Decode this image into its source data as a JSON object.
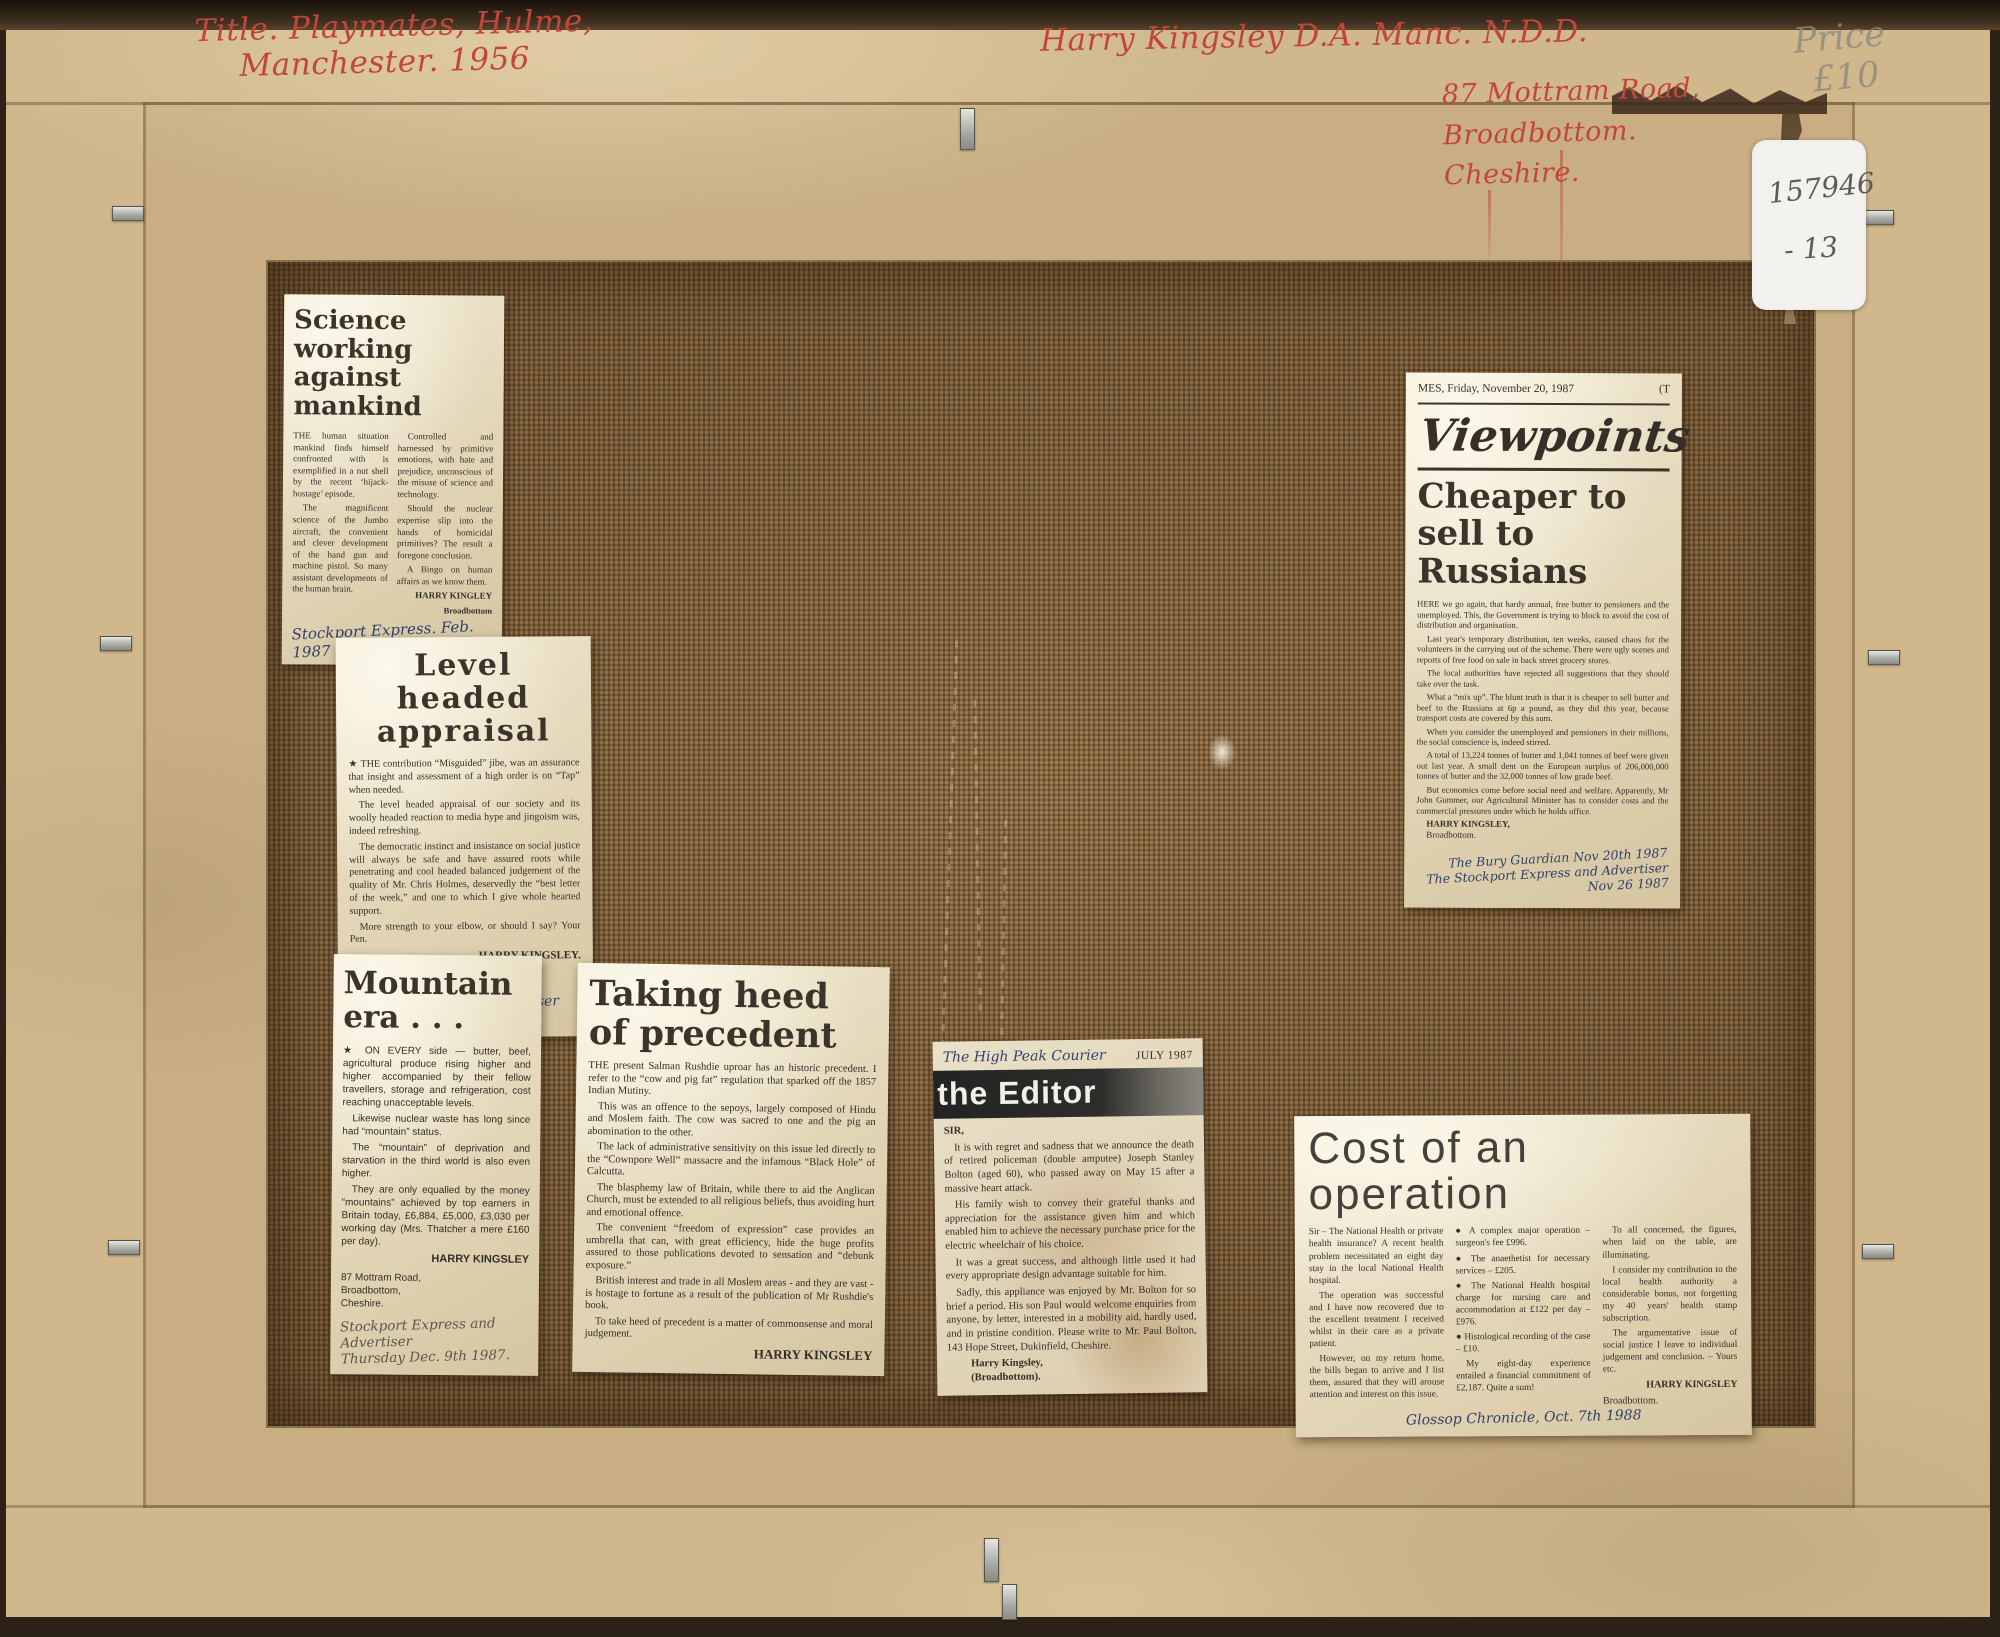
{
  "annotations": {
    "title": {
      "line1": "Title. Playmates, Hulme,",
      "line2": "Manchester. 1956"
    },
    "artist": {
      "name": "Harry Kingsley D.A. Manc. N.D.D.",
      "address_line1": "87 Mottram Road,",
      "address_line2": "Broadbottom.",
      "address_line3": "Cheshire."
    },
    "price": {
      "line1": "Price",
      "line2": "£10"
    },
    "sticker": {
      "line1": "157946",
      "line2": "- 13"
    },
    "ink_color": "#c2473a",
    "pencil_color": "#8d887e"
  },
  "clippings": {
    "science": {
      "headline": [
        "Science working",
        "against mankind"
      ],
      "paragraphs": [
        "THE human situation mankind finds himself confronted with is exemplified in a nut shell by the recent ‘hijack-hostage’ episode.",
        "The magnificent science of the Jumbo aircraft, the convenient and clever development of the hand gun and machine pistol. So many assistant developments of the human brain.",
        "Controlled and harnessed by primitive emotions, with hate and prejudice, unconscious of the misuse of science and technology.",
        "Should the nuclear expertise slip into the hands of homicidal primitives? The result a foregone conclusion.",
        "A Bingo on human affairs as we know them."
      ],
      "byline": "HARRY KINGLEY",
      "byline_place": "Broadbottom",
      "source": "Stockport Express. Feb. 1987"
    },
    "level": {
      "headline": [
        "Level headed",
        "appraisal"
      ],
      "paragraphs": [
        "★ THE contribution “Misguided” jibe, was an assurance that insight and assessment of a high order is on “Tap” when needed.",
        "The level headed appraisal of our society and its woolly headed reaction to media hype and jingoism was, indeed refreshing.",
        "The democratic instinct and insistance on social justice will always be safe and have assured roots while penetrating and cool headed balanced judgement of the quality of Mr. Chris Holmes, deservedly the “best letter of the week,” and one to which I give whole hearted support.",
        "More strength to your elbow, or should I say? Your Pen."
      ],
      "byline": "HARRY KINGSLEY.",
      "address": [
        "Mottram Road,",
        "Broadbottom"
      ],
      "source": "Stockport Express Advertiser Dec 31st 1987"
    },
    "mountain": {
      "headline": [
        "Mountain",
        "era . . ."
      ],
      "paragraphs": [
        "★ ON EVERY side — butter, beef, agricultural produce rising higher and higher accompanied by their fellow travellers, storage and refrigeration, cost reaching unacceptable levels.",
        "Likewise nuclear waste has long since had “mountain” status.",
        "The “mountain” of deprivation and starvation in the third world is also even higher.",
        "They are only equalled by the money “mountains” achieved by top earners in Britain today, £6,884, £5,000, £3,030 per working day (Mrs. Thatcher a mere £160 per day)."
      ],
      "byline": "HARRY KINGSLEY",
      "address": [
        "87 Mottram Road,",
        "Broadbottom,",
        "Cheshire."
      ],
      "source": [
        "Stockport Express and Advertiser",
        "Thursday Dec. 9th 1987."
      ]
    },
    "precedent": {
      "headline": [
        "Taking heed",
        "of precedent"
      ],
      "paragraphs": [
        "THE present Salman Rushdie uproar has an historic precedent. I refer to the “cow and pig fat” regulation that sparked off the 1857 Indian Mutiny.",
        "This was an offence to the sepoys, largely composed of Hindu and Moslem faith. The cow was sacred to one and the pig an abomination to the other.",
        "The lack of administrative sensitivity on this issue led directly to the “Cownpore Well” massacre and the infamous “Black Hole” of Calcutta.",
        "The blasphemy law of Britain, while there to aid the Anglican Church, must be extended to all religious beliefs, thus avoiding hurt and emotional offence.",
        "The convenient “freedom of expression” case provides an umbrella that can, with great efficiency, hide the huge profits assured to those publications devoted to sensation and “debunk exposure.”",
        "British interest and trade in all Moslem areas - and they are vast - is hostage to fortune as a result of the publication of Mr Rushdie's book.",
        "To take heed of precedent is a matter of commonsense and moral judgement."
      ],
      "byline": "HARRY KINGSLEY"
    },
    "editor": {
      "source_hand": "The High Peak Courier",
      "date_printed": "JULY 1987",
      "banner": "the Editor",
      "salutation": "SIR,",
      "paragraphs": [
        "It is with regret and sadness that we announce the death of retired policeman (double amputee) Joseph Stanley Bolton (aged 60), who passed away on May 15 after a massive heart attack.",
        "His family wish to convey their grateful thanks and appreciation for the assistance given him and which enabled him to achieve the necessary purchase price for the electric wheelchair of his choice.",
        "It was a great success, and although little used it had every appropriate design advantage suitable for him.",
        "Sadly, this appliance was enjoyed by Mr. Bolton for so brief a period. His son Paul would welcome enquiries from anyone, by letter, interested in a mobility aid, hardly used, and in pristine condition. Please write to Mr. Paul Bolton, 143 Hope Street, Dukinfield, Cheshire."
      ],
      "byline": "Harry Kingsley,",
      "byline_place": "(Broadbottom)."
    },
    "viewpoints": {
      "dateline": "MES, Friday, November 20, 1987",
      "dateline_right": "(T",
      "masthead": "Viewpoints",
      "headline": [
        "Cheaper to",
        "sell to",
        "Russians"
      ],
      "paragraphs": [
        "HERE we go again, that hardy annual, free butter to pensioners and the unemployed. This, the Government is trying to block to avoid the cost of distribution and organisation.",
        "Last year's temporary distribution, ten weeks, caused chaos for the volunteers in the carrying out of the scheme. There were ugly scenes and reports of free food on sale in back street grocery stores.",
        "The local authorities have rejected all suggestions that they should take over the task.",
        "What a “mix up”. The blunt truth is that it is cheaper to sell butter and beef to the Russians at 6p a pound, as they did this year, because transport costs are covered by this sum.",
        "When you consider the unemployed and pensioners in their millions, the social conscience is, indeed stirred.",
        "A total of 13,224 tonnes of butter and 1,041 tonnes of beef were given out last year. A small dent on the European surplus of 206,000,000 tonnes of butter and the 32,000 tonnes of low grade beef.",
        "But economics come before social need and welfare. Apparently, Mr John Gummer, our Agricultural Minister has to consider costs and the commercial pressures under which he holds office."
      ],
      "byline": "HARRY KINGSLEY,",
      "byline_place": "Broadbottom.",
      "source": [
        "The Bury Guardian Nov 20th 1987",
        "The Stockport Express and Advertiser Nov 26 1987"
      ]
    },
    "cost": {
      "headline": "Cost of an operation",
      "paragraphs": [
        "Sir – The National Health or private health insurance? A recent health problem necessitated an eight day stay in the local National Health hospital.",
        "The operation was successful and I have now recovered due to the excellent treatment I received whilst in their care as a private patient.",
        "However, on my return home, the bills began to arrive and I list them, assured that they will arouse attention and interest on this issue.",
        "● A complex major operation – surgeon's fee £996.",
        "● The anaethetist for necessary services – £205.",
        "● The National Health hospital charge for nursing care and accommodation at £122 per day – £976.",
        "● Histological recording of the case – £10.",
        "My eight-day experience entailed a financial commitment of £2,187. Quite a sum!",
        "To all concerned, the figures, when laid on the table, are illuminating.",
        "I consider my contribution to the local health authority a considerable bonus, not forgetting my 40 years' health stamp subscription.",
        "The argumentative issue of social justice I leave to individual judgement and conclusion. – Yours etc."
      ],
      "byline": "HARRY KINGSLEY",
      "byline_place": "Broadbottom.",
      "source": "Glossop Chronicle, Oct. 7th 1988"
    }
  }
}
